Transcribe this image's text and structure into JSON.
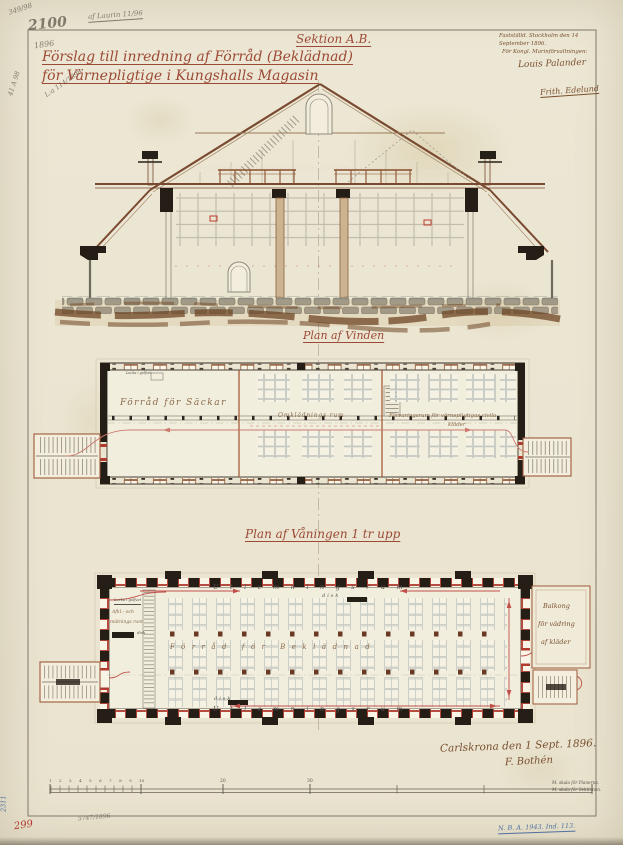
{
  "sheet": {
    "paper_color": "#ece7d4",
    "red_ink": "#9c4a36",
    "wall_black": "#241e16",
    "accent_red": "#b03a2e",
    "shelf_line": "#a9b2b0",
    "wood_brown": "#8a5a38"
  },
  "pencil_notes": {
    "n1": "349/98",
    "n2": "2100",
    "n3": "1896",
    "n4": "af Laurin 11/96",
    "n5": "L:a 114/1898",
    "n6": "41 A 98",
    "bottom": "5747/1896"
  },
  "title": {
    "section_label": "Sektion A.B.",
    "line1": "Förslag till inredning af Förråd (Beklädnad)",
    "line2": "för Värnepligtige i Kungshalls Magasin"
  },
  "approval": {
    "line1": "Fastställd. Stockholm den 14",
    "line2": "September 1896.",
    "line3": "För Kongl. Marinförvaltningen:",
    "signature1": "Louis Palander",
    "signature2": "Frith. Edelund"
  },
  "plan_vinden": {
    "label": "Plan af Vinden",
    "room_sacks": "Förråd för Säckar",
    "room_changing": "Omklädnings rum",
    "room_storage_line1": "Förvaringsrum för värnepligtigas civila",
    "room_storage_line2": "kläder",
    "hatch_note": "Lucka i golfvet"
  },
  "plan_vaning": {
    "label": "Plan af Våningen 1 tr upp",
    "band_top": "Utlemningsrum",
    "desk_top": "disk",
    "band_mid": "Förråd för Beklädnad",
    "band_bottom": "Utlemningsrum",
    "desk_bottom": "disk",
    "left_room_note": "Lucka i golfvet",
    "left_room_line1": "Afkl.- och",
    "left_room_line2": "mätnings rum",
    "left_room_line3": "disk",
    "balcony_line1": "Balkong",
    "balcony_line2": "för vädring",
    "balcony_line3": "af kläder"
  },
  "footer": {
    "place_date": "Carlskrona den 1 Sept. 1896.",
    "signature": "F. Bothén",
    "scale_numbers": "1 2 3 4 5 6 7 8 9 10",
    "scale_20": "20",
    "scale_30": "30",
    "scale_note1": "M. skala för Planerna.",
    "scale_note2": "M. skala för Sektionen.",
    "red_number": "299",
    "blue_side": "2311",
    "blue_right": "N. B. A. 1943. Ind. 113."
  }
}
